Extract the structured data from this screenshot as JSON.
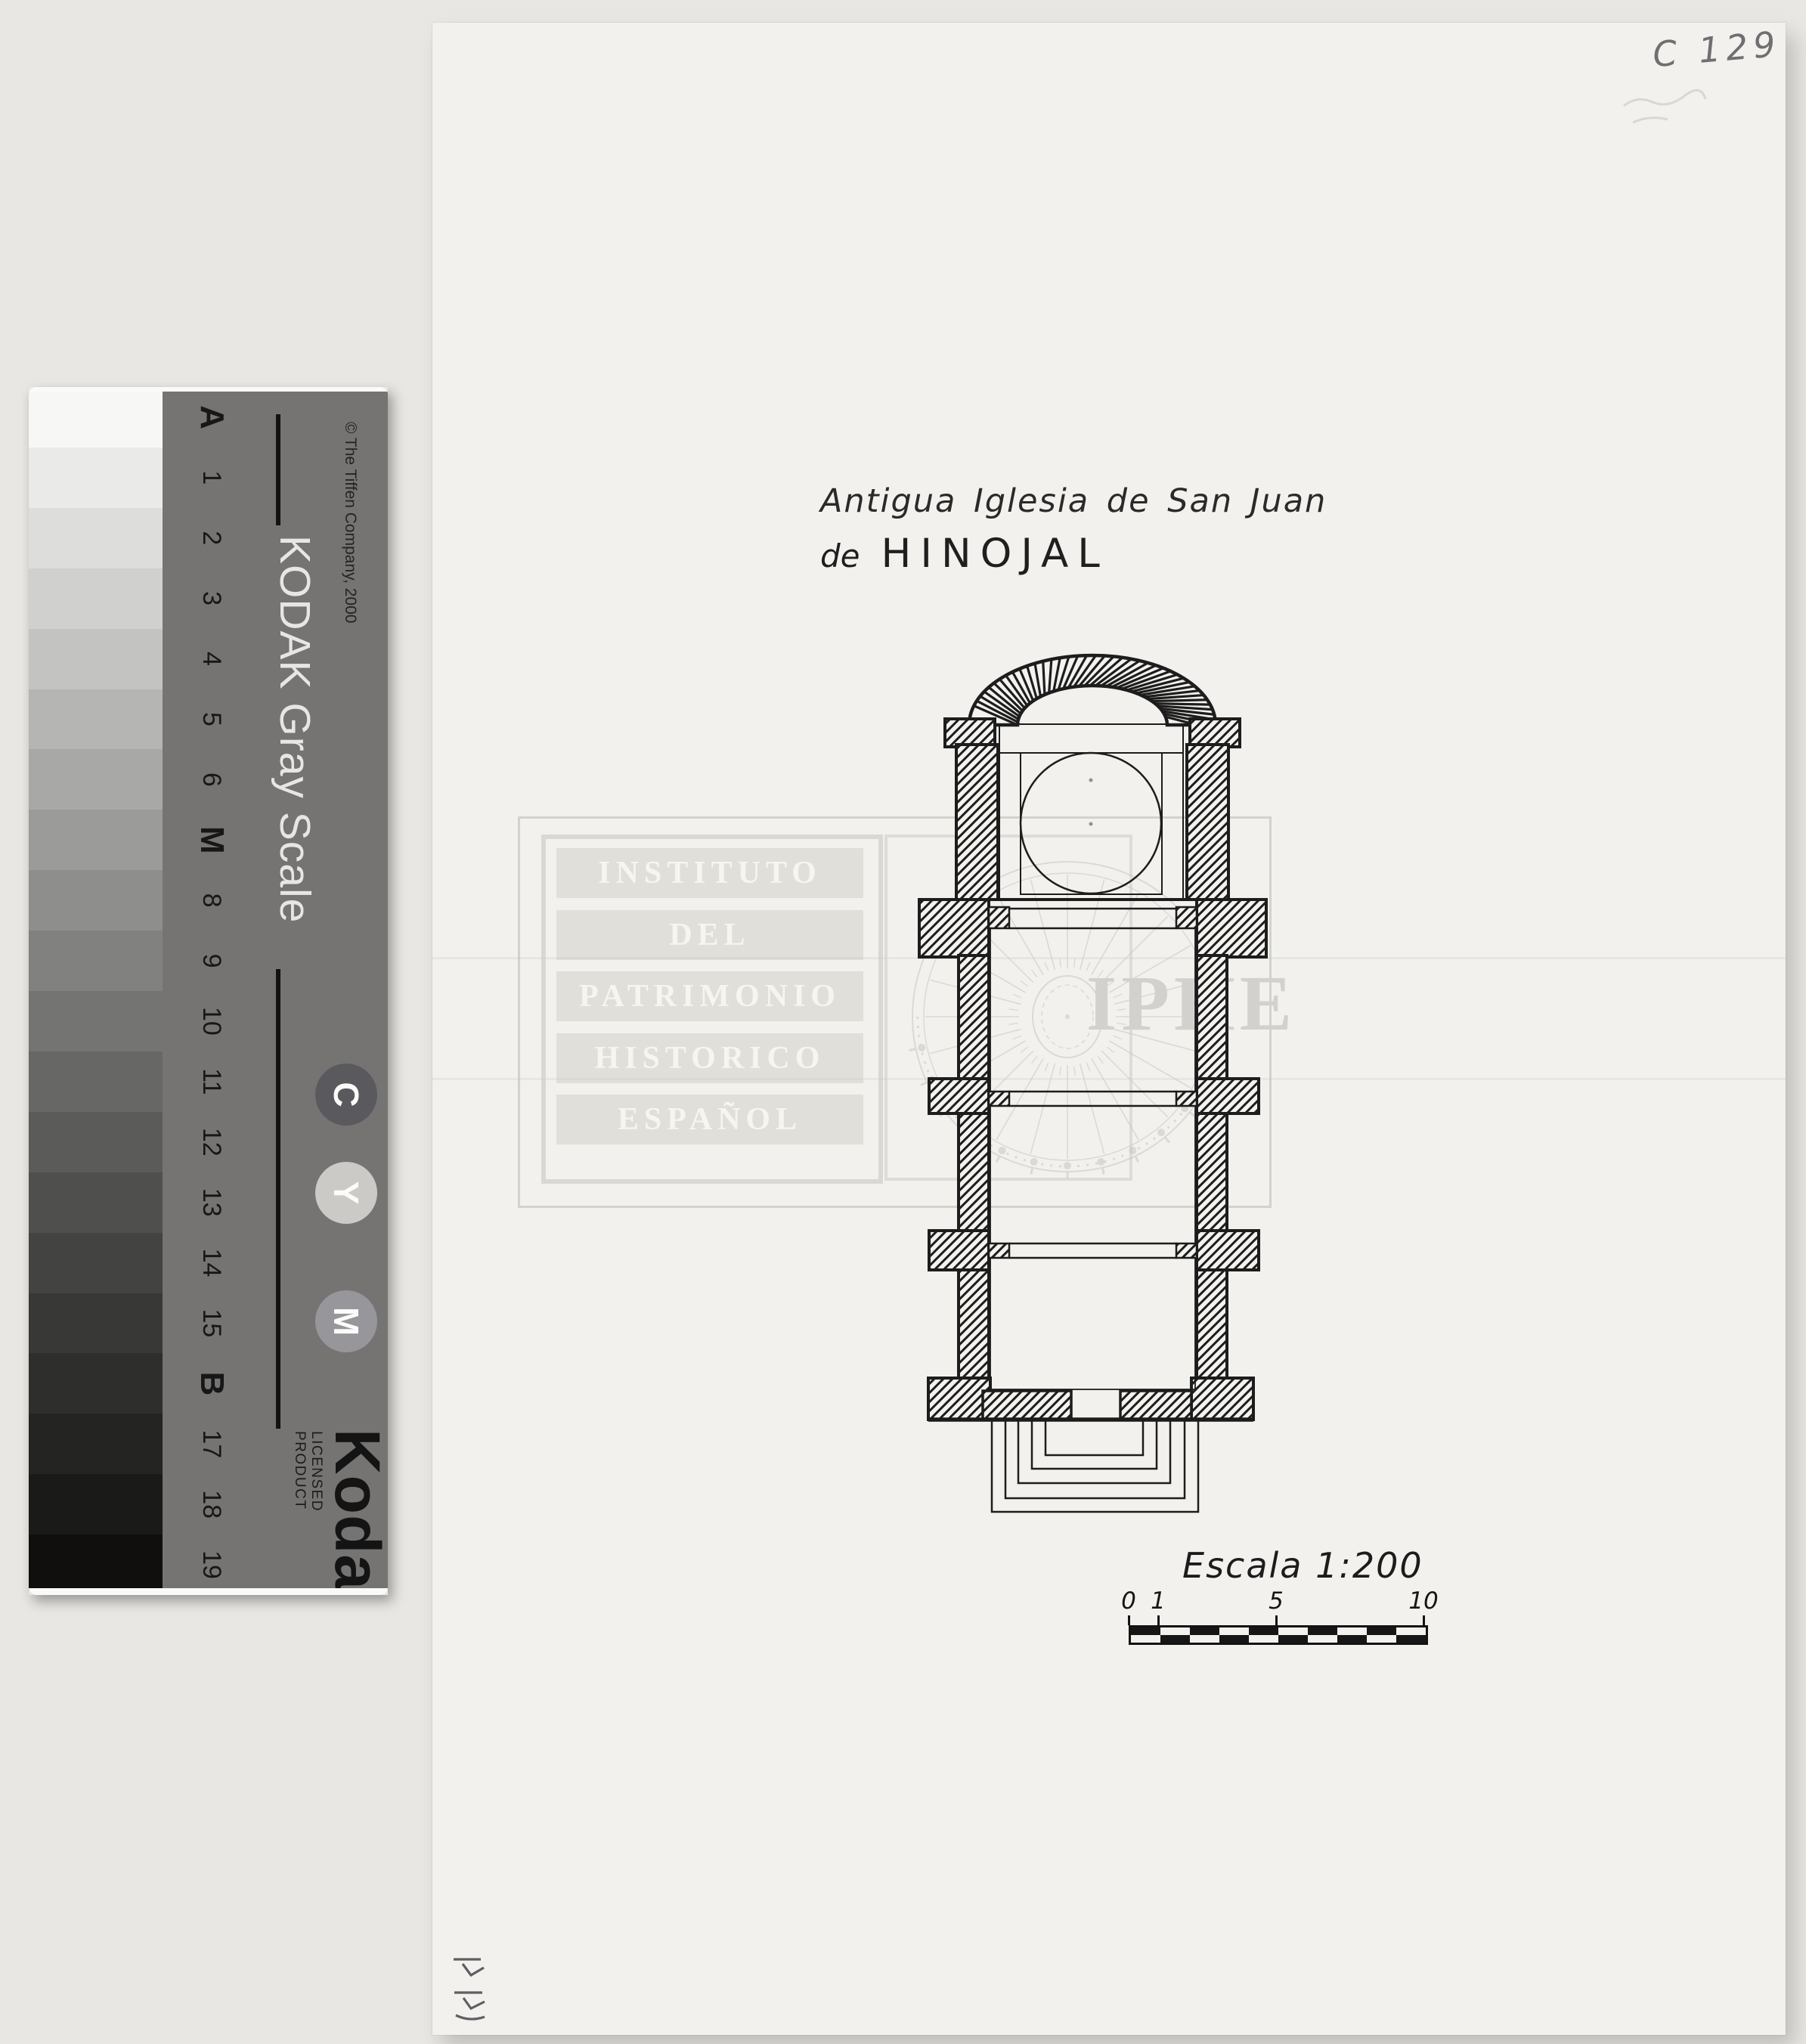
{
  "scan": {
    "archive_code": "C 129",
    "margin_mark": "HH"
  },
  "drawing": {
    "title_line1": "Antigua Iglesia de San Juan",
    "title_line2_prefix": "de",
    "title_line2_name": "HINOJAL",
    "scale_label": "Escala 1:200",
    "scale_bar": {
      "units_total": 10,
      "ticks": [
        {
          "label": "0",
          "unit": 0
        },
        {
          "label": "1",
          "unit": 1
        },
        {
          "label": "5",
          "unit": 5
        },
        {
          "label": "10",
          "unit": 10
        }
      ]
    }
  },
  "watermark": {
    "lines": [
      "INSTITUTO",
      "DEL",
      "PATRIMONIO",
      "HISTORICO",
      "ESPAÑOL"
    ],
    "acronym": "IPHE"
  },
  "kodak_strip": {
    "heading": "KODAK Gray Scale",
    "copyright": "© The Tiffen Company, 2000",
    "logo_text": "Kodak",
    "licensed_text": "LICENSED PRODUCT",
    "ink_circles": [
      {
        "label": "C",
        "color": "#5a5a5e"
      },
      {
        "label": "Y",
        "color": "#cbcac6"
      },
      {
        "label": "M",
        "color": "#97969a"
      }
    ],
    "patches": [
      {
        "label": "A",
        "bold": true,
        "color": "#f7f7f5"
      },
      {
        "label": "1",
        "bold": false,
        "color": "#eaeae8"
      },
      {
        "label": "2",
        "bold": false,
        "color": "#dddddb"
      },
      {
        "label": "3",
        "bold": false,
        "color": "#d0d0ce"
      },
      {
        "label": "4",
        "bold": false,
        "color": "#c3c3c1"
      },
      {
        "label": "5",
        "bold": false,
        "color": "#b5b5b3"
      },
      {
        "label": "6",
        "bold": false,
        "color": "#a8a8a6"
      },
      {
        "label": "M",
        "bold": true,
        "color": "#9b9b99"
      },
      {
        "label": "8",
        "bold": false,
        "color": "#8e8e8c"
      },
      {
        "label": "9",
        "bold": false,
        "color": "#81817f"
      },
      {
        "label": "10",
        "bold": false,
        "color": "#747472"
      },
      {
        "label": "11",
        "bold": false,
        "color": "#676765"
      },
      {
        "label": "12",
        "bold": false,
        "color": "#5b5b59"
      },
      {
        "label": "13",
        "bold": false,
        "color": "#4f4f4d"
      },
      {
        "label": "14",
        "bold": false,
        "color": "#434341"
      },
      {
        "label": "15",
        "bold": false,
        "color": "#383836"
      },
      {
        "label": "B",
        "bold": true,
        "color": "#2e2e2c"
      },
      {
        "label": "17",
        "bold": false,
        "color": "#242422"
      },
      {
        "label": "18",
        "bold": false,
        "color": "#1a1a18"
      },
      {
        "label": "19",
        "bold": false,
        "color": "#100f0e"
      }
    ]
  }
}
